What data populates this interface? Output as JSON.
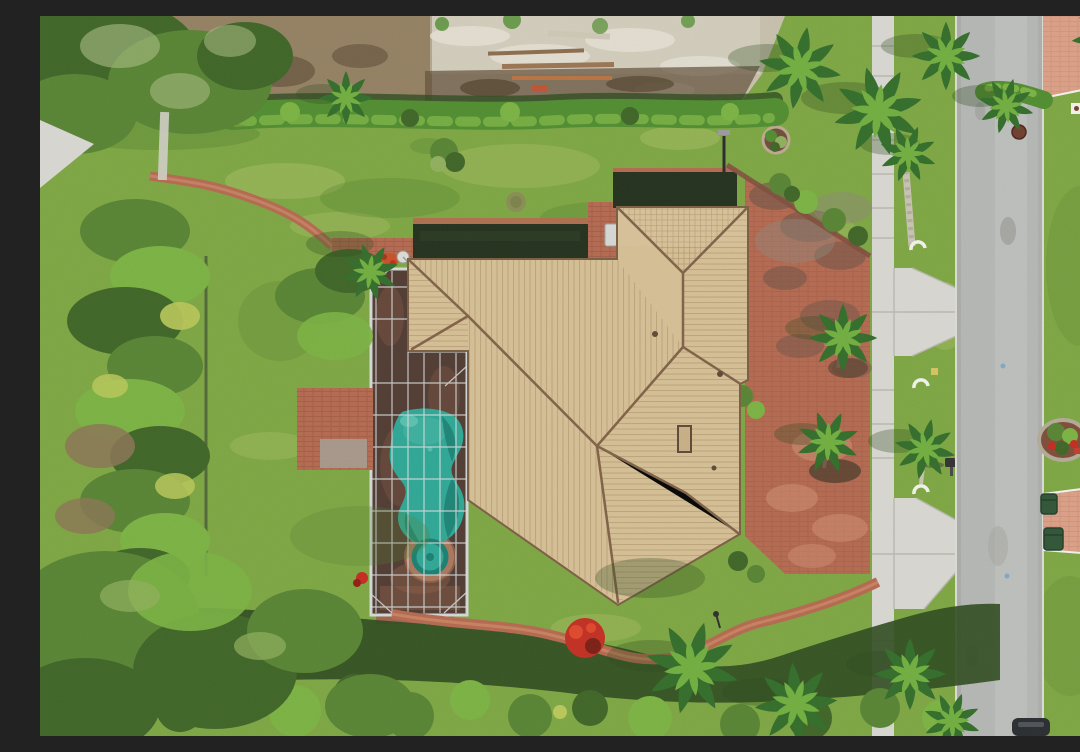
{
  "scene": {
    "description": "Aerial top-down drone photo of a single-family home with a tan barrel-tile hip roof, a screened pool enclosure with a freeform teal pool and round spa on its west side, a large weathered red-brick paver driveway on the east side leading to a concrete sidewalk and a gray residential street. The lot is ringed by hedges, tropical foliage and palm trees, with a sandy vacant lot to the north and a neighboring salmon paver drive across the street.",
    "elements": [
      {
        "name": "vacant-lot",
        "label": "Sandy vacant lot with lumber"
      },
      {
        "name": "north-hedge",
        "label": "North boundary hedge"
      },
      {
        "name": "house-roof",
        "label": "Tan tile hip roof"
      },
      {
        "name": "pool-enclosure",
        "label": "Screened pool cage"
      },
      {
        "name": "swimming-pool",
        "label": "Freeform teal pool"
      },
      {
        "name": "spa",
        "label": "Round spa"
      },
      {
        "name": "brick-driveway",
        "label": "Red brick paver driveway"
      },
      {
        "name": "sidewalk",
        "label": "Concrete sidewalk and aprons"
      },
      {
        "name": "road",
        "label": "Asphalt street"
      },
      {
        "name": "east-verge",
        "label": "East parkway with planting bed and bins"
      },
      {
        "name": "palm-trees",
        "label": "Palm trees"
      },
      {
        "name": "south-hedge",
        "label": "South boundary hedge and garden path"
      },
      {
        "name": "vehicle",
        "label": "Car at bottom edge of road"
      }
    ]
  },
  "palette": {
    "lawn": "#7CA63F",
    "lawnLight": "#ABBF63",
    "lawnDark": "#4F7D2A",
    "lawnMid": "#8FB44C",
    "dirt": "#C7C0AC",
    "dirtLight": "#E4E0D3",
    "dirtBrown": "#8A7352",
    "dirtDark": "#5E4B35",
    "hedge": "#4E8C2C",
    "hedgeLight": "#79B23F",
    "hedgeShadow": "#2A481B",
    "canopy": "#55822F",
    "canopyLight": "#8FAF5A",
    "canopyDark": "#3C6323",
    "palmDark": "#2F6B26",
    "palmLight": "#6FAE3C",
    "roof": "#D6BF94",
    "roofLight": "#E6D4AE",
    "roofStripe": "#A98F66",
    "roofRidge": "#7E5F43",
    "deckDark": "#4E382E",
    "deckLight": "#8A5A43",
    "screenFrame": "#D9DEDF",
    "pool": "#2BA795",
    "poolDark": "#157E6F",
    "poolLight": "#63C6B4",
    "brick": "#B4674D",
    "brickDark": "#7E4A3A",
    "brickLight": "#D29274",
    "brickWeather": "#6E5144",
    "concrete": "#D9D8D2",
    "concreteJoint": "#B9B8B0",
    "road": "#B5B7B4",
    "roadLight": "#C8CAC6",
    "curb": "#DDDDD6",
    "salmon": "#DD9F85",
    "mulchRed": "#8E3A28",
    "flowerRed": "#C5271B",
    "binGreen": "#2C5233",
    "carDark": "#26292C",
    "trunk": "#C9C3B2",
    "white": "#F4F4EF",
    "marker": "#D7C45E",
    "manhole": "#6E3A2A"
  }
}
